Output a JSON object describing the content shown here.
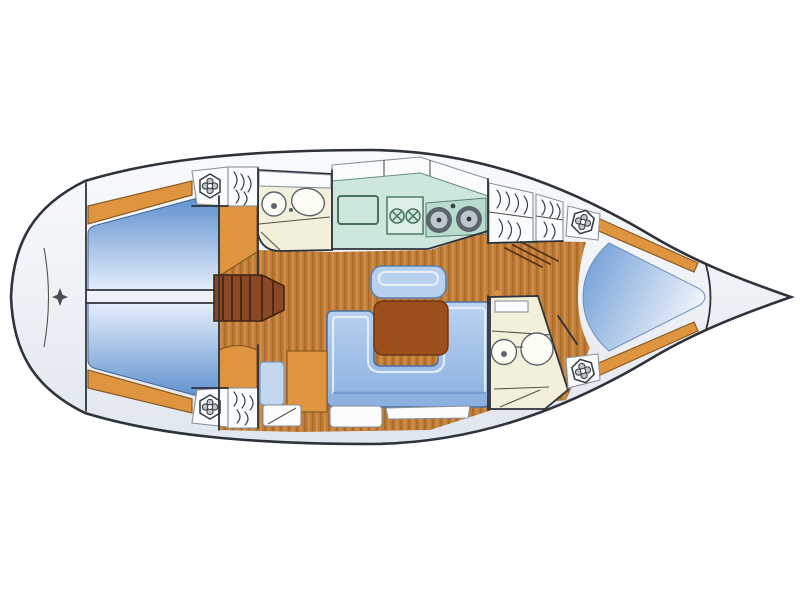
{
  "diagram": {
    "title": "sailing-yacht-interior-floor-plan",
    "view": "top-down deck layout, bow pointing right, stern rounded at left",
    "orientation": {
      "bow": "right",
      "stern": "left",
      "port": "top",
      "starboard": "bottom"
    },
    "compartments": [
      {
        "name": "stern-deck",
        "fixtures": [
          "transom locker",
          "helm compass rose"
        ]
      },
      {
        "name": "aft-cabin-port",
        "fixtures": [
          "double berth",
          "hull shelf in wood"
        ]
      },
      {
        "name": "aft-cabin-starboard",
        "fixtures": [
          "double berth",
          "hull shelf in wood"
        ]
      },
      {
        "name": "companionway",
        "fixtures": [
          "steps",
          "flanking cabinets"
        ]
      },
      {
        "name": "aft-head",
        "fixtures": [
          "toilet",
          "washbasin",
          "shelf",
          "door"
        ]
      },
      {
        "name": "galley",
        "fixtures": [
          "refrigerator",
          "two-burner-stove",
          "twin-round-sinks",
          "overhead lockers"
        ]
      },
      {
        "name": "salon",
        "fixtures": [
          "u-shaped-settee",
          "folding-table",
          "bench-seat",
          "stowage lockers"
        ]
      },
      {
        "name": "nav-station",
        "fixtures": [
          "seat",
          "chart-cabinet",
          "lockers"
        ]
      },
      {
        "name": "wardrobe-aft-port",
        "fixtures": [
          "hanging locker"
        ]
      },
      {
        "name": "wardrobe-aft-starboard",
        "fixtures": [
          "hanging locker"
        ]
      },
      {
        "name": "wardrobe-forward",
        "fixtures": [
          "two hanging lockers"
        ]
      },
      {
        "name": "forward-head",
        "fixtures": [
          "toilet",
          "washbasin",
          "shelf",
          "door"
        ]
      },
      {
        "name": "forward-cabin",
        "fixtures": [
          "v-berth",
          "hull shelves in wood",
          "louvered door"
        ]
      },
      {
        "name": "anchor-locker",
        "fixtures": []
      },
      {
        "name": "deck-winches",
        "fixtures": [
          "port-aft",
          "starboard-aft",
          "port-forward",
          "starboard-forward"
        ]
      }
    ],
    "colors": {
      "hull_outline": "#2e333b",
      "deck_light": "#f7f9fb",
      "deck_shade": "#dfe5ee",
      "wood_floor": "#c17c38",
      "wood_dark": "#9d5f1f",
      "wood_light": "#dba15f",
      "cabinet": "#df9440",
      "steps": "#8a4824",
      "steps_line": "#3f2210",
      "table": "#9c4e1d",
      "berth_dark": "#5c8fce",
      "berth_light": "#e6effb",
      "settee": "#a9c6ec",
      "settee_dark": "#7ba6da",
      "settee_line": "#4e6f9e",
      "counter": "#cde7dc",
      "counter_dark": "#b7dccd",
      "appliance": "#47705f",
      "fixture": "#5c646b",
      "fixture_light": "#bdc6cc",
      "cream": "#f2efdb",
      "room_line": "#55544a",
      "hatch": "#3c4048"
    }
  }
}
